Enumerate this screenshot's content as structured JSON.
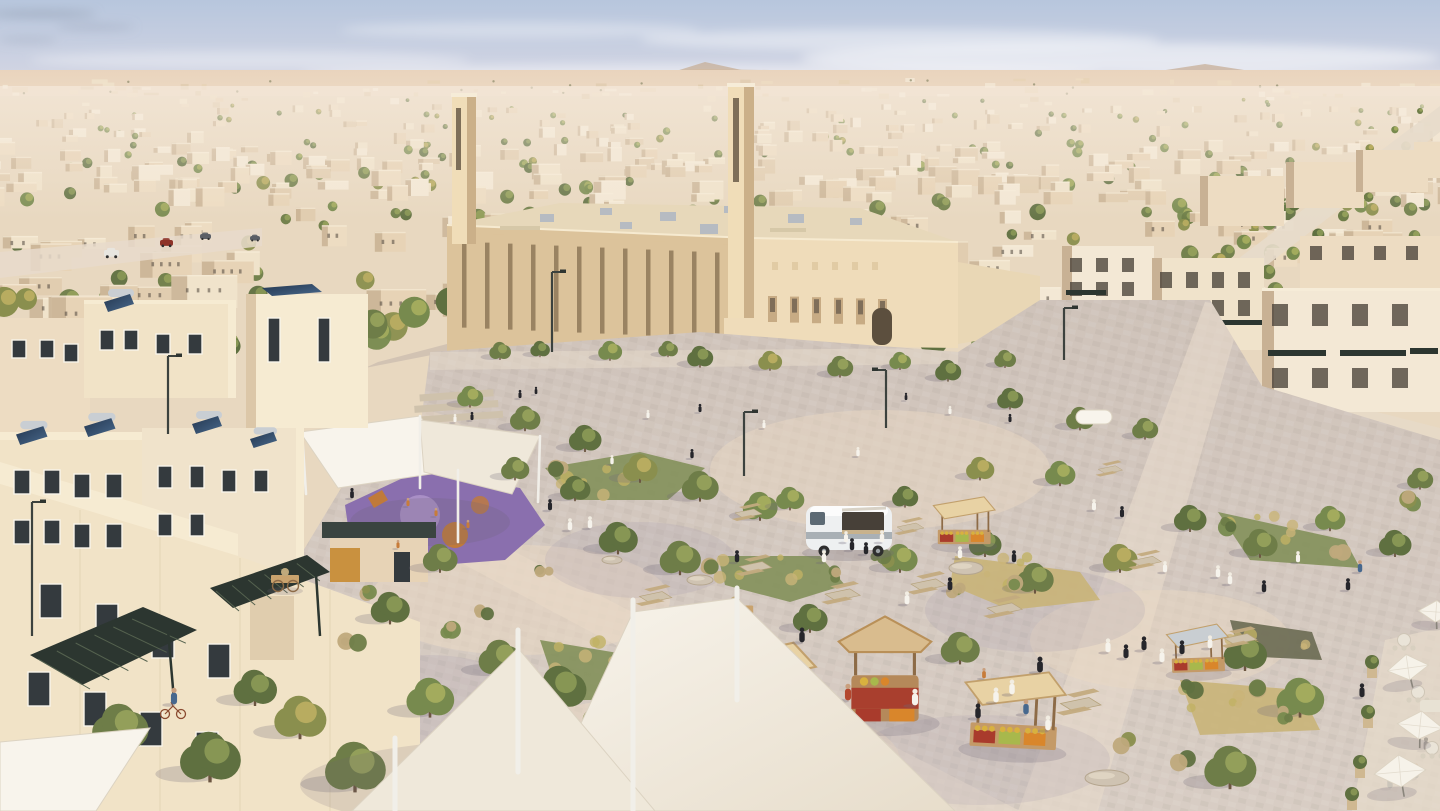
{
  "scene": {
    "title": "Aerial rendering of a sustainable desert city: a sand-colored mosque with twin minarets, solar-topped villas, tree-lined streets and a lively market plaza with stalls, canopies and a food truck",
    "width": 1440,
    "height": 811,
    "seed": 11,
    "palette": {
      "sky_top": "#b7c6dd",
      "sky_mid": "#d6d7e4",
      "sky_low": "#ece1e3",
      "sky_horizon": "#f6e9e0",
      "cloud": "#ffffff",
      "cloud_dark": "#909cae",
      "hill": "#d2b99f",
      "hill_far": "#c4ab91",
      "desert_far": "#e9d4bd",
      "desert_near": "#f1e1cd",
      "underlay": "#e8d8c0",
      "wall_a": "#f3e8d5",
      "wall_b": "#eddcc2",
      "wall_c": "#e7d3b6",
      "wall_d": "#f0e3cb",
      "wall_e": "#e1cdb0",
      "wall_shade": "#c8b194",
      "window_dark": "#4e463c",
      "parapet_hi": "#f6ecd8",
      "green_a": "#6e7d48",
      "green_b": "#5f7040",
      "green_c": "#778a4e",
      "green_d": "#8a8f4e",
      "light_a": "#9aa55e",
      "light_b": "#8e9c58",
      "light_c": "#aab060",
      "light_d": "#c0b264",
      "green_dry": "#bfa97c",
      "bed_green": "#83905a",
      "bed_dry": "#c9b478",
      "shrub_dark": "#6a6a52",
      "trunk": "#6b5540",
      "mosque_lit": "#efdcba",
      "mosque_shade": "#dcc39b",
      "mosque_slot": "#8a7354",
      "mosque_roof": "#e7d8ba",
      "roof_unit": "#b6bbc2",
      "courtyard": "#e9d7b5",
      "minaret_lit": "#f0ddb8",
      "minaret_shade": "#cbb089",
      "minaret_slot": "#6a5c48",
      "plaza_a": "#d8cdc4",
      "plaza_b": "#cfc3ba",
      "plaza_light": "#ecdac4",
      "plaza_shadow": "#a49cae",
      "path_light": "#e7dbcb",
      "villa_wall": "#f1e3c7",
      "villa_lit": "#f6ebd2",
      "villa_shade": "#dcc7a8",
      "frame": "#f8f4ea",
      "win": "#343a3e",
      "pv": "#2c3630",
      "pv_stripe": "#55624f",
      "panel": "#23364f",
      "panel_hi": "#49698c",
      "tank": "#c9ced3",
      "accent": "#c9913f",
      "roof_slab": "#3a4440",
      "play_base": "#8a6fae",
      "play_light": "#a98fc6",
      "play_orange": "#c07a3a",
      "play_tan": "#d9a864",
      "sail": "#f8f4ec",
      "sail2": "#efe8da",
      "sail_stroke": "#dcd3c2",
      "pole": "#f1efe9",
      "stall_roof": "#d9bc8e",
      "stall_roof2": "#e8d2a4",
      "stall_wood": "#b5895a",
      "stall_dark": "#8d6b47",
      "crate": "#a93b2c",
      "prod_o": "#d9862b",
      "prod_g": "#a8b84c",
      "prod_y": "#d8b13f",
      "roof_metal": "#c9ced2",
      "cart_wood": "#c9a36e",
      "truck": "#eef0f1",
      "truck_band": "#a9b0b5",
      "truck_win": "#5d6a74",
      "wheel": "#2e2e2e",
      "umb": "#f6f2e9",
      "umb_pole": "#8a857c",
      "thobe": "#f6f3ec",
      "abaya": "#26262b",
      "skin": "#c99f7e",
      "red": "#b3472e",
      "blue": "#47688e",
      "gray": "#8b8f94",
      "kid": "#c77c3a",
      "lamp": "#3c423e",
      "boulder": "#cfc3b2",
      "boulder_line": "#b5a68f",
      "shadow": "#6e6678",
      "car_red": "#8e3328",
      "car_white": "#e8e6e0",
      "car_dark": "#5b5f66",
      "bench": "#cfc2ac"
    },
    "counts": {
      "settlements": 55,
      "far_buildings": 300,
      "far_trees": 150,
      "mid_buildings": 95,
      "mid_trees": 70,
      "belt_trees": 30,
      "avenue_trees": 15
    }
  }
}
